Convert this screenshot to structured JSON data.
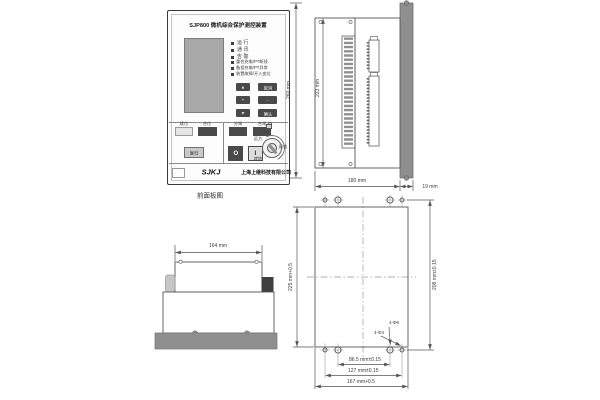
{
  "figure": {
    "front_caption": "前面板图"
  },
  "front_panel": {
    "title": "SJP800 微机综合保护测控装置",
    "status_leds": [
      {
        "label": "运  行"
      },
      {
        "label": "通  讯"
      },
      {
        "label": "告  警"
      }
    ],
    "alarm_leds": [
      {
        "label": "重合充电/PT断线"
      },
      {
        "label": "备投充电/PT异常"
      },
      {
        "label": "装置故障/开入变位"
      }
    ],
    "keypad": {
      "up": "▲",
      "cancel": "取消",
      "plus": "+",
      "minus": "-",
      "down": "▼",
      "confirm": "确认"
    },
    "signal": {
      "trip": "跳位",
      "close": "合位",
      "reset": "复归"
    },
    "operate": {
      "open_label": "分闸",
      "close_label": "合闸",
      "open_symbol": "O",
      "close_symbol": "I"
    },
    "rotary": {
      "remote": "远方",
      "lock": "闭锁",
      "local": "就地"
    },
    "brand": {
      "logo": "SJKJ",
      "company": "上海上继科技有限公司"
    }
  },
  "side_view": {
    "total_height": "260 mm",
    "case_height": "223 mm",
    "case_depth": "180 mm",
    "panel_thickness": "19 mm"
  },
  "top_view": {
    "width": "164 mm"
  },
  "cutout": {
    "height": "225 mm+0.5",
    "hole_spacing_v": "208 mm±0.15",
    "hole_spacing_h1": "86.5 mm±0.15",
    "hole_spacing_h2": "127 mm±0.15",
    "width": "167 mm+0.5",
    "callout_phi6": "4-Φ6",
    "callout_phi4": "4-Φ4"
  }
}
